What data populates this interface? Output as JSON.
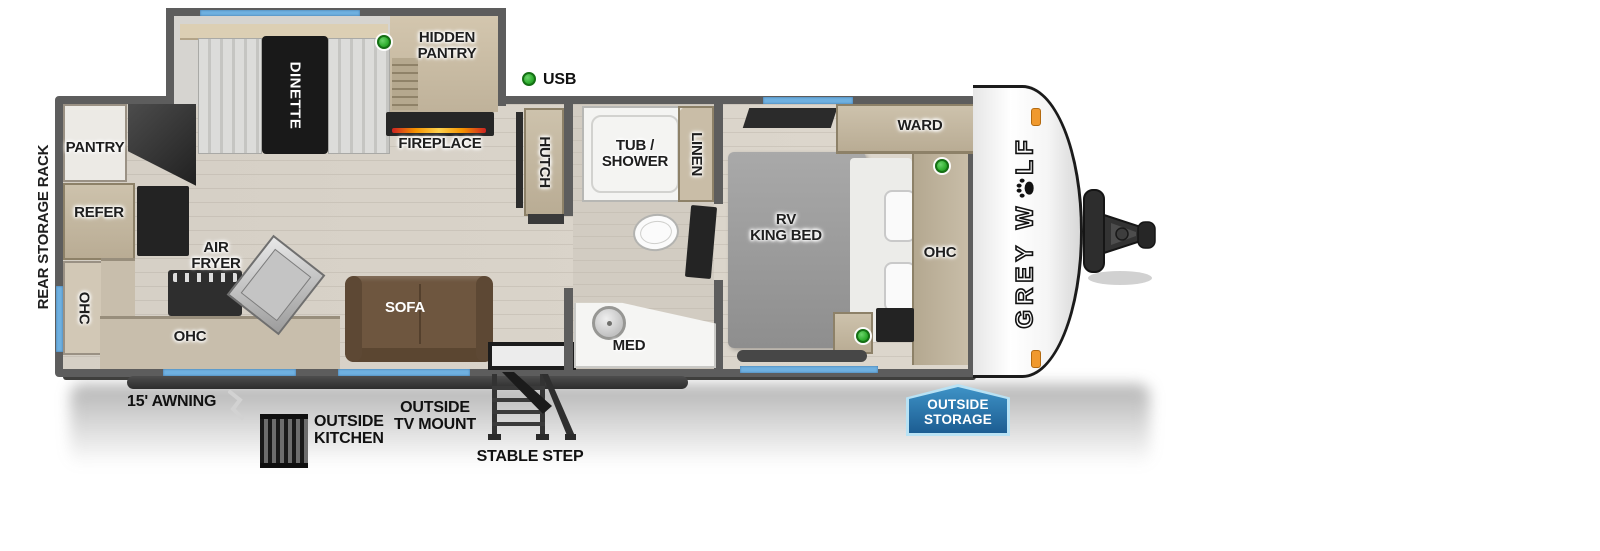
{
  "floorplan": {
    "brand": {
      "p1": "GREY W",
      "p2": "LF"
    },
    "rear_label": "REAR STORAGE RACK",
    "legend": {
      "usb": "USB"
    },
    "rooms": {
      "pantry": "PANTRY",
      "refer": "REFER",
      "ohc_left": "OHC",
      "dinette": "DINETTE",
      "hidden_pantry": "HIDDEN\nPANTRY",
      "fireplace": "FIREPLACE",
      "air_fryer": "AIR\nFRYER",
      "ohc_kitchen": "OHC",
      "sofa": "SOFA",
      "hutch": "HUTCH",
      "tub_shower": "TUB /\nSHOWER",
      "linen": "LINEN",
      "med": "MED",
      "rv_king_bed": "RV\nKING BED",
      "ward": "WARD",
      "ohc_bedroom": "OHC"
    },
    "exterior": {
      "awning": "15' AWNING",
      "outside_kitchen": "OUTSIDE\nKITCHEN",
      "outside_tv_mount": "OUTSIDE\nTV MOUNT",
      "stable_step": "STABLE STEP",
      "outside_storage": "OUTSIDE\nSTORAGE"
    },
    "colors": {
      "window_blue": "#6fb0e0",
      "usb_green": "#2fae2f",
      "badge_blue": "#2e7fb5",
      "marker_orange": "#f0992e",
      "sofa_brown": "#6e563f"
    }
  }
}
